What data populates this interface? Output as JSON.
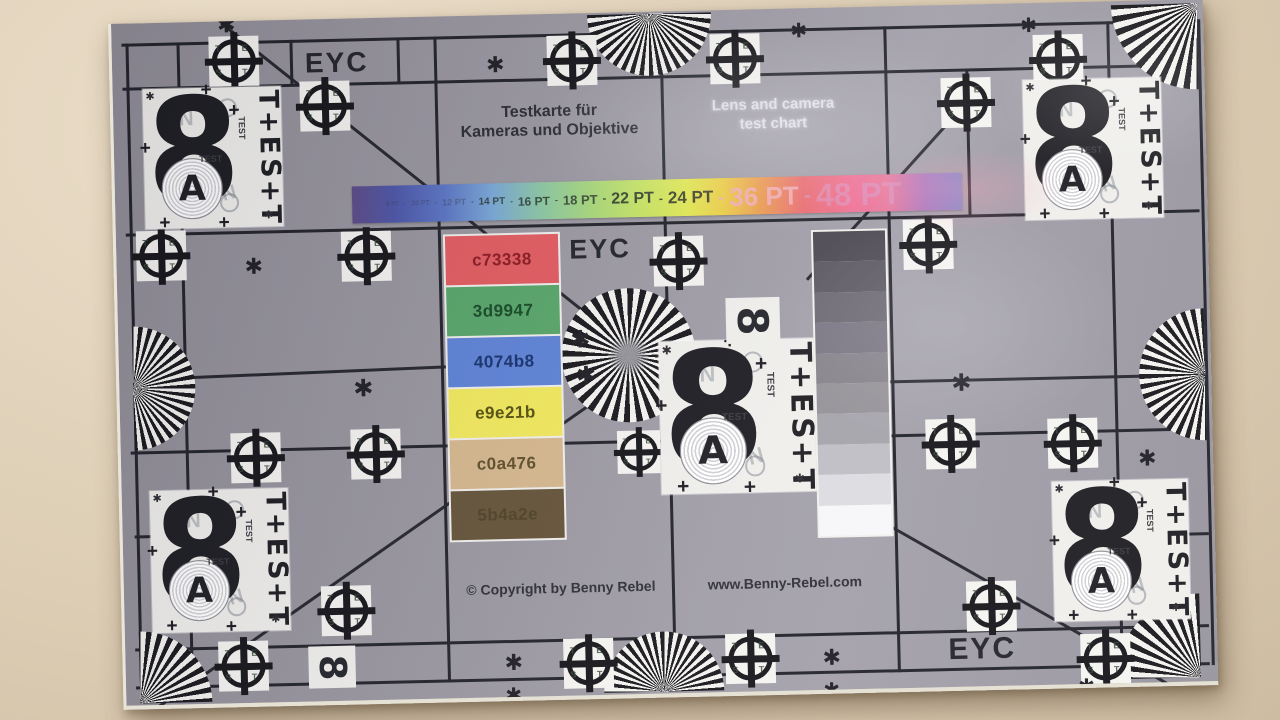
{
  "header": {
    "title_de_line1": "Testkarte für",
    "title_de_line2": "Kameras und Objektive",
    "title_en_line1": "Lens and camera",
    "title_en_line2": "test chart"
  },
  "eyc_label": "EYC",
  "font_size_bar": {
    "separator": "-",
    "gradient_stops": [
      "#5b4a86 0%",
      "#4b55a8 7%",
      "#5a74c4 15%",
      "#79a8d8 23%",
      "#8cc8a4 31%",
      "#a8d87c 39%",
      "#c6e464 47%",
      "#e2e850 55%",
      "#eccc44 61%",
      "#eb9a4e 67%",
      "#e96a70 74%",
      "#ef6f95 82%",
      "#e77a9e 88%",
      "#a878c0 94%",
      "#8086c6 100%"
    ],
    "labels": [
      {
        "text": "8 PT",
        "px": 6,
        "color": "rgba(45,55,60,0.35)"
      },
      {
        "text": "10 PT",
        "px": 7,
        "color": "rgba(45,55,60,0.35)"
      },
      {
        "text": "12 PT",
        "px": 9,
        "color": "rgba(45,55,60,0.38)"
      },
      {
        "text": "14 PT",
        "px": 10,
        "color": "rgba(35,48,38,0.8)"
      },
      {
        "text": "16 PT",
        "px": 12,
        "color": "rgba(35,48,38,0.8)"
      },
      {
        "text": "18 PT",
        "px": 13,
        "color": "rgba(35,48,38,0.8)"
      },
      {
        "text": "22 PT",
        "px": 16,
        "color": "rgba(32,44,36,0.85)"
      },
      {
        "text": "24 PT",
        "px": 17,
        "color": "rgba(38,40,36,0.85)"
      },
      {
        "text": "36 PT",
        "px": 26,
        "color": "rgba(242,172,182,0.9)"
      },
      {
        "text": "48 PT",
        "px": 32,
        "color": "rgba(212,162,210,0.45)"
      }
    ]
  },
  "color_patches": [
    {
      "hex_label": "c73338",
      "fill": "#e25b60",
      "label_color": "#8a1a24"
    },
    {
      "hex_label": "3d9947",
      "fill": "#57a569",
      "label_color": "#164a26"
    },
    {
      "hex_label": "4074b8",
      "fill": "#5d82d6",
      "label_color": "#17316e"
    },
    {
      "hex_label": "e9e21b",
      "fill": "#f1e95c",
      "label_color": "#55500f"
    },
    {
      "hex_label": "c0a476",
      "fill": "#d5b78e",
      "label_color": "#5f4e2a"
    },
    {
      "hex_label": "5b4a2e",
      "fill": "#655339",
      "label_color": "#4f4128"
    }
  ],
  "grayscale_steps": [
    "#4d4953",
    "#5b5761",
    "#6a6671",
    "#777381",
    "#858189",
    "#949097",
    "#a5a3ab",
    "#bfbec4",
    "#dcdce0",
    "#f7f7f9"
  ],
  "footer": {
    "copyright": "© Copyright by Benny Rebel",
    "website": "www.Benny-Rebel.com"
  },
  "test_card": {
    "digit": "8",
    "letter": "A",
    "column": [
      "T",
      "+",
      "E",
      "S",
      "+",
      "T"
    ],
    "small_label": "TEST",
    "ghost_letter": "N"
  },
  "crosshair_letters": [
    "T",
    "E",
    "S",
    "T"
  ],
  "glyphs": {
    "asterisk": "✱"
  }
}
